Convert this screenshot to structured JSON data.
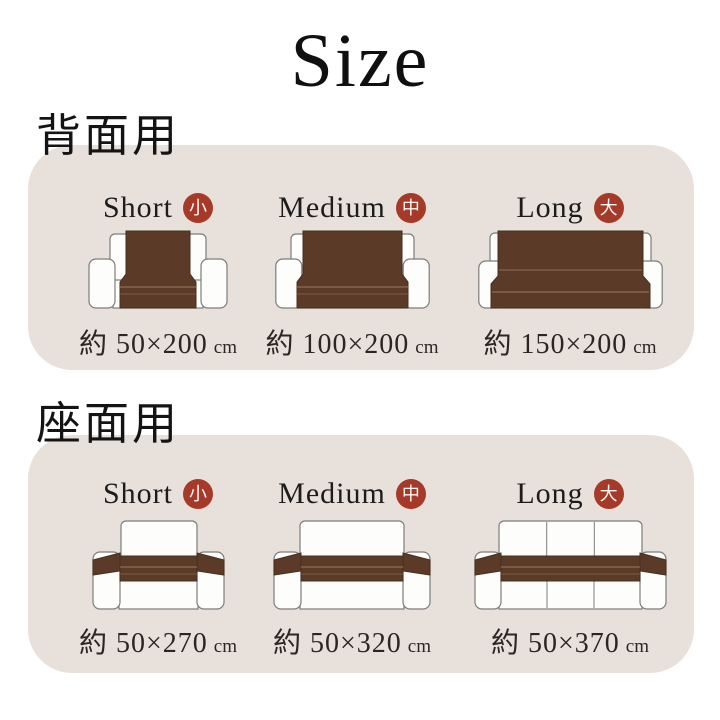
{
  "page": {
    "title": "Size"
  },
  "colors": {
    "panel_bg": "#e8e0da",
    "badge_red": "#a53a28",
    "cover_brown": "#5b3a27",
    "sofa_outline": "#7d7d7d",
    "text_dark": "#141414"
  },
  "sections": [
    {
      "heading": "背面用",
      "items": [
        {
          "label": "Short",
          "badge": "小",
          "size": "約 50×200",
          "unit": "cm"
        },
        {
          "label": "Medium",
          "badge": "中",
          "size": "約 100×200",
          "unit": "cm"
        },
        {
          "label": "Long",
          "badge": "大",
          "size": "約 150×200",
          "unit": "cm"
        }
      ]
    },
    {
      "heading": "座面用",
      "items": [
        {
          "label": "Short",
          "badge": "小",
          "size": "約 50×270",
          "unit": "cm"
        },
        {
          "label": "Medium",
          "badge": "中",
          "size": "約 50×320",
          "unit": "cm"
        },
        {
          "label": "Long",
          "badge": "大",
          "size": "約 50×370",
          "unit": "cm"
        }
      ]
    }
  ]
}
